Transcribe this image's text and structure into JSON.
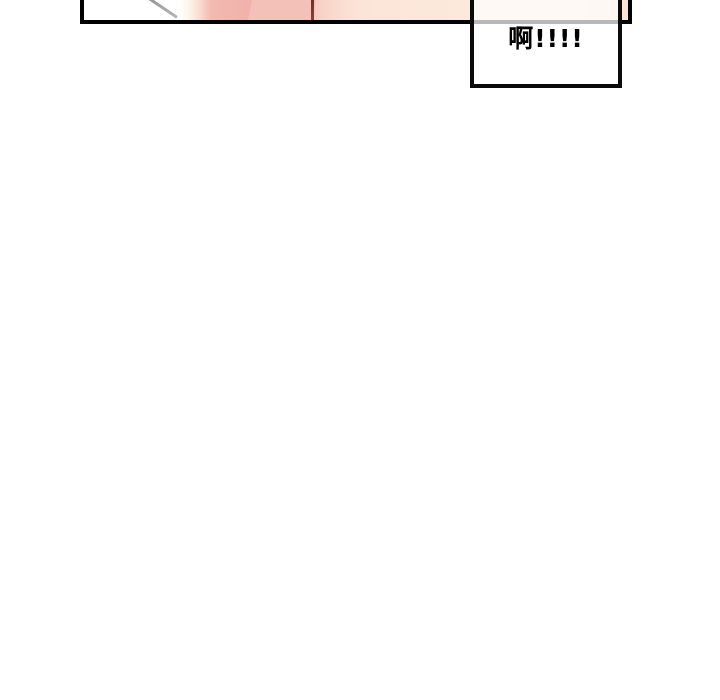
{
  "page": {
    "background_color": "#ffffff"
  },
  "panel": {
    "border_color": "#000000",
    "artwork_colors": {
      "white_area": "#ffffff",
      "cream": "#fdf7eb",
      "skin_pink": "#f0b2aa",
      "skin_pink_light": "#f3c1b7",
      "pale_peach": "#fce9dc",
      "peach_right_edge": "#fae3d5",
      "motion_line_gray": "#8a8a8a",
      "crease_line_dark_red": "#5f2421"
    }
  },
  "speech_box": {
    "text": "啊!!!!",
    "fill_color": "#ffffff",
    "fill_opacity": "0.72",
    "border_color": "#0a0a0a",
    "text_color": "#000000",
    "panel_border_seen_through_box_color": "#b8b8b8"
  }
}
